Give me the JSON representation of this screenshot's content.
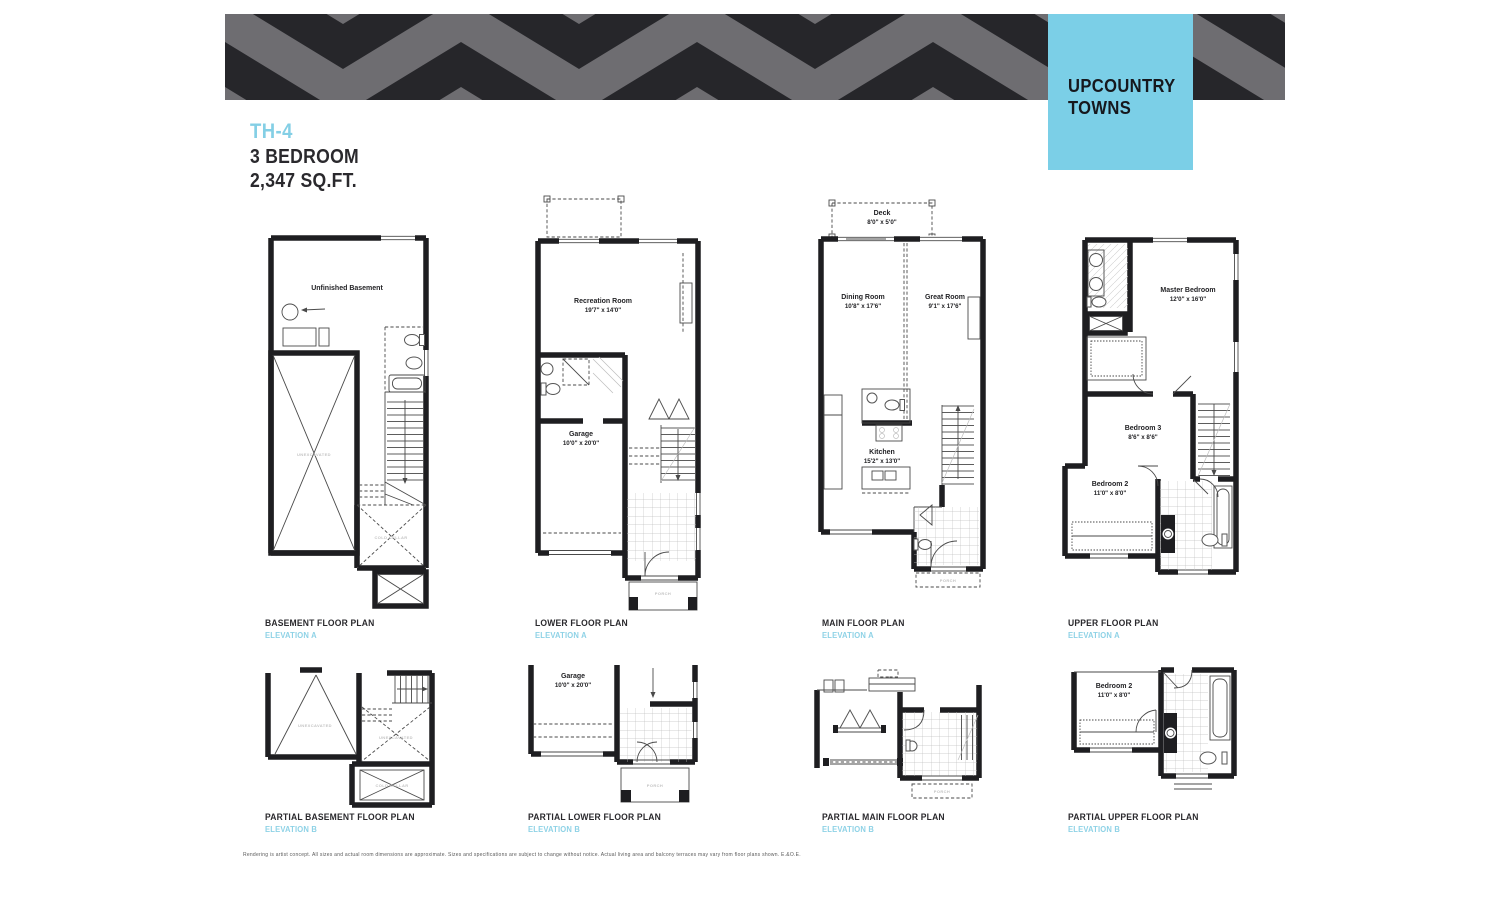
{
  "page": {
    "brand": {
      "line1": "UPCOUNTRY",
      "line2": "TOWNS"
    },
    "unit": {
      "model": "TH-4",
      "type": "3 BEDROOM",
      "area": "2,347 SQ.FT."
    },
    "disclaimer": "Rendering is artist concept. All sizes and actual room dimensions are approximate. Sizes and specifications are subject to change without notice. Actual living area and balcony terraces may vary from floor plans shown. E.&O.E.",
    "colors": {
      "accent_blue": "#84cfe5",
      "ink": "#2a292d",
      "banner_black": "#26262a",
      "banner_gray": "#6e6d71",
      "brand_box_blue": "#7bcfe7"
    }
  },
  "annotations": {
    "unexcavated": "UNEXCAVATED",
    "cold_cellar": "COLD CELLAR",
    "porch": "PORCH"
  },
  "plans": {
    "basement": {
      "caption": "BASEMENT FLOOR PLAN",
      "elevation": "ELEVATION A",
      "rooms": {
        "basement": {
          "name": "Unfinished Basement",
          "dims": ""
        }
      }
    },
    "lower": {
      "caption": "LOWER FLOOR PLAN",
      "elevation": "ELEVATION A",
      "rooms": {
        "rec": {
          "name": "Recreation Room",
          "dims": "19'7\" x 14'0\""
        },
        "garage": {
          "name": "Garage",
          "dims": "10'0\" x 20'0\""
        }
      }
    },
    "main": {
      "caption": "MAIN FLOOR PLAN",
      "elevation": "ELEVATION A",
      "rooms": {
        "deck": {
          "name": "Deck",
          "dims": "8'0\" x 5'0\""
        },
        "dining": {
          "name": "Dining Room",
          "dims": "10'8\" x 17'6\""
        },
        "great": {
          "name": "Great Room",
          "dims": "9'1\" x 17'6\""
        },
        "kitchen": {
          "name": "Kitchen",
          "dims": "15'2\" x 13'0\""
        }
      }
    },
    "upper": {
      "caption": "UPPER FLOOR PLAN",
      "elevation": "ELEVATION A",
      "rooms": {
        "master": {
          "name": "Master Bedroom",
          "dims": "12'0\" x 16'0\""
        },
        "bed3": {
          "name": "Bedroom 3",
          "dims": "8'6\" x 8'6\""
        },
        "bed2": {
          "name": "Bedroom 2",
          "dims": "11'0\" x 8'0\""
        }
      }
    },
    "partial_basement": {
      "caption": "PARTIAL BASEMENT FLOOR PLAN",
      "elevation": "ELEVATION B"
    },
    "partial_lower": {
      "caption": "PARTIAL LOWER FLOOR PLAN",
      "elevation": "ELEVATION B",
      "rooms": {
        "garage": {
          "name": "Garage",
          "dims": "10'0\" x 20'0\""
        }
      }
    },
    "partial_main": {
      "caption": "PARTIAL MAIN FLOOR PLAN",
      "elevation": "ELEVATION B"
    },
    "partial_upper": {
      "caption": "PARTIAL UPPER FLOOR PLAN",
      "elevation": "ELEVATION B",
      "rooms": {
        "bed2": {
          "name": "Bedroom 2",
          "dims": "11'0\" x 8'0\""
        }
      }
    }
  }
}
